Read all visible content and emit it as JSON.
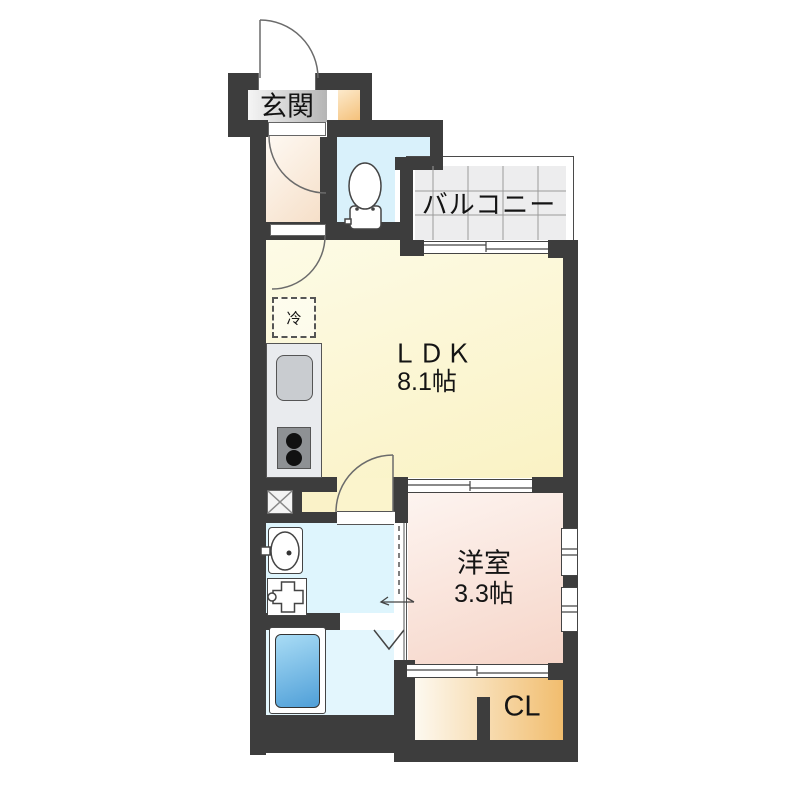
{
  "plan": {
    "kind": "japanese-apartment-floorplan",
    "rooms": {
      "genkan": {
        "label": "玄関"
      },
      "balcony": {
        "label": "バルコニー"
      },
      "ldk": {
        "label": "ＬＤＫ",
        "size": "8.1帖"
      },
      "western_room": {
        "label": "洋室",
        "size": "3.3帖"
      },
      "closet": {
        "label": "CL"
      }
    },
    "fixtures": {
      "refrigerator": {
        "label": "冷"
      },
      "toilet": "toilet",
      "kitchen_sink": "sink",
      "stove": "2-burner stove",
      "bathtub": "bathtub",
      "washbasin": "washbasin",
      "washer_pan": "washing-machine-pan",
      "pipe_shaft": "x-box"
    },
    "colors": {
      "wall": "#3d3d3d",
      "genkan_floor": "#b5b5b5",
      "shoe_cabinet": "#f4bf77",
      "hall_floor": "#f6dfc8",
      "toilet_floor": "#d9f1fb",
      "ldk_floor": "#faf2c4",
      "western_room_floor": "#f6d5c8",
      "closet_floor": "#f1bd6e",
      "washroom_floor": "#def5fd",
      "bathroom_floor": "#e3f6fd",
      "bathtub": "#4f9fd8",
      "balcony_tile": "#ededee"
    }
  }
}
